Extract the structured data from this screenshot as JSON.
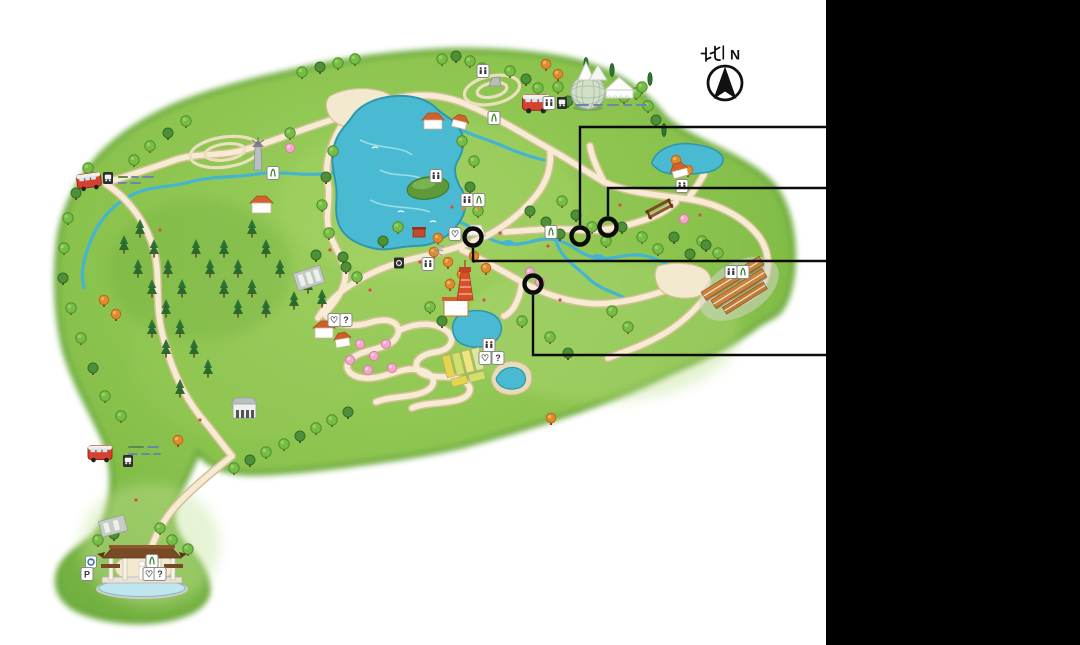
{
  "window": {
    "width": 1080,
    "height": 645,
    "background": "#ffffff"
  },
  "right_panel": {
    "x": 826,
    "width": 254,
    "color": "#000000"
  },
  "compass": {
    "north_cn": "北",
    "divider": "|",
    "north_en": "N"
  },
  "annotation": {
    "line_color": "#0c0c0c",
    "line_width": 2.4,
    "circle_stroke_width": 4.4,
    "line_end_x": 828,
    "callouts": [
      {
        "label": "callout-1",
        "cx": 580,
        "cy": 236,
        "r": 8.5,
        "elbow_y": 127,
        "direction": "up"
      },
      {
        "label": "callout-2",
        "cx": 608,
        "cy": 227,
        "r": 8.5,
        "elbow_y": 188,
        "direction": "up"
      },
      {
        "label": "callout-3",
        "cx": 473,
        "cy": 237,
        "r": 8.5,
        "elbow_y": 261,
        "direction": "down"
      },
      {
        "label": "callout-4",
        "cx": 533,
        "cy": 284,
        "r": 8.5,
        "elbow_y": 355,
        "direction": "down"
      }
    ]
  },
  "signs": {
    "parking": "P",
    "question": "?",
    "heart": "♡"
  },
  "map": {
    "style": "hand-drawn illustrated park map",
    "landmarks": [
      "main-lake",
      "lake-island",
      "north-east-pond",
      "mid-pond",
      "small-pond",
      "stream-network",
      "geodesic-greenhouse-dome",
      "event-tents",
      "sightseeing-tram",
      "shuttle-bus-west",
      "shuttle-bus-south",
      "red-lattice-tower",
      "roofed-exhibition-complex",
      "trellis",
      "white-pavilion",
      "arch-bridge",
      "lakeside-cottages",
      "windmill-tower",
      "grey-hall",
      "parking-structures",
      "flower-beds",
      "cherry-grove",
      "pine-forest",
      "autumn-trees",
      "maze-garden",
      "entrance-gate",
      "entrance-pool",
      "statue"
    ],
    "colors": {
      "land": "#8fc74e",
      "land_edge": "#68a838",
      "lake": "#49bad1",
      "path": "#f5ecd3",
      "path_edge": "#d5bf94",
      "stream": "#45b4d2"
    }
  }
}
